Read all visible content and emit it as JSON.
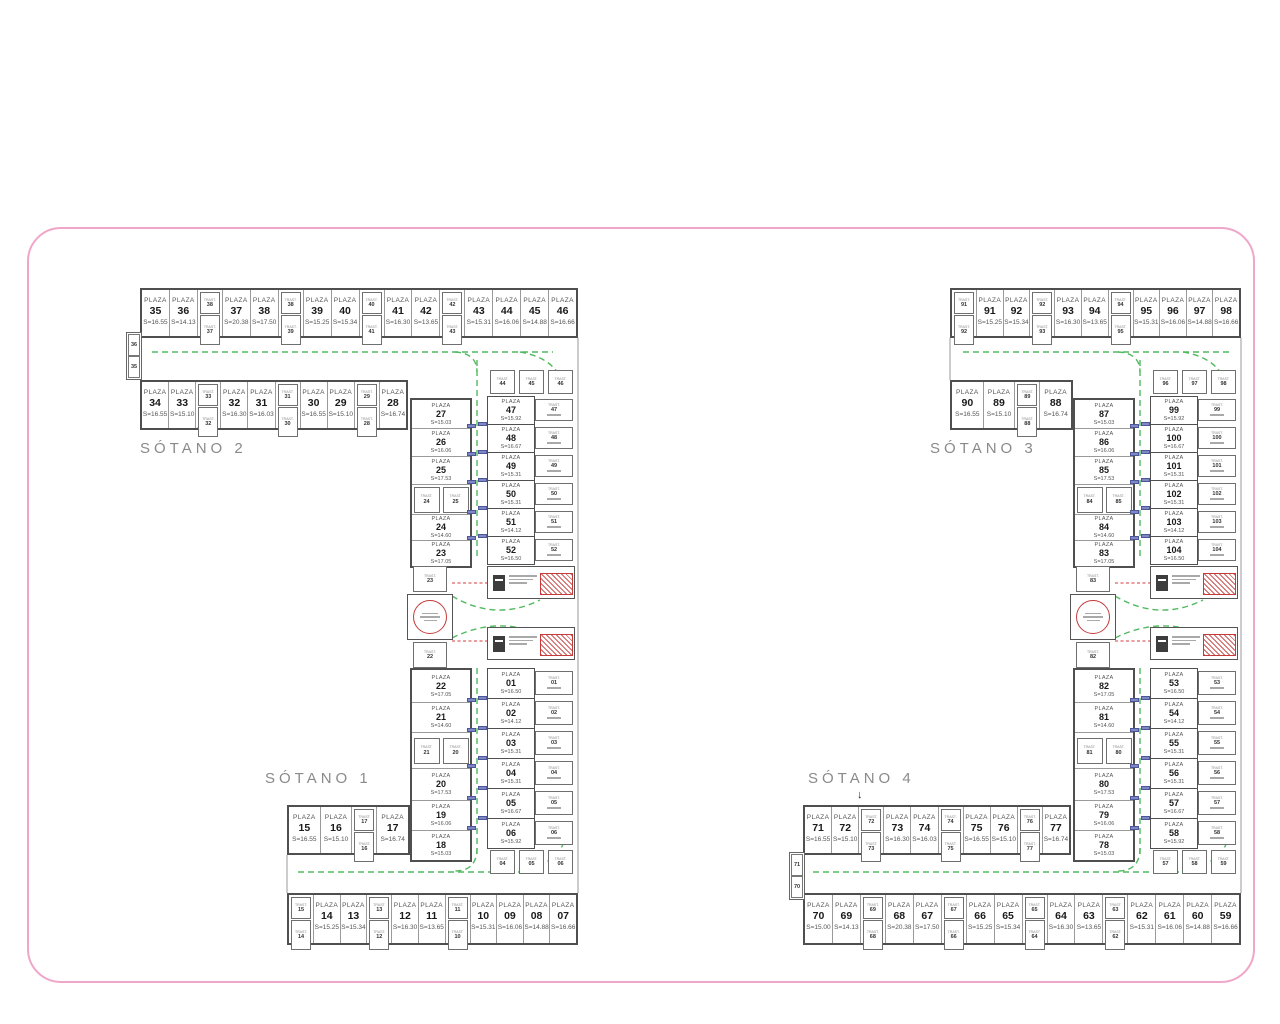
{
  "colors": {
    "boundary_pink": "#f0a6c8",
    "lane_green": "#3fb24e",
    "ramp_red": "#e06060",
    "stair_red": "#c43b3b",
    "door_blue": "#7f88c2",
    "wall_gray": "#4f4f4f"
  },
  "words": {
    "plaza": "PLAZA",
    "trast": "TRAST.",
    "area_prefix": "S=",
    "arrows": {
      "up": "↑",
      "down": "↓"
    }
  },
  "floors": {
    "sotano1": "SÓTANO 1",
    "sotano2": "SÓTANO 2",
    "sotano3": "SÓTANO 3",
    "sotano4": "SÓTANO 4"
  },
  "plans": [
    {
      "label_top": "SÓTANO 2",
      "label_bottom": "SÓTANO 1",
      "row_a": [
        {
          "n": "35",
          "s": "16.55"
        },
        {
          "n": "36",
          "s": "14.13"
        },
        {
          "t": [
            "38",
            "37"
          ]
        },
        {
          "n": "37",
          "s": "20.38"
        },
        {
          "n": "38",
          "s": "17.50"
        },
        {
          "t": [
            "38",
            "39"
          ]
        },
        {
          "n": "39",
          "s": "15.25"
        },
        {
          "n": "40",
          "s": "15.34"
        },
        {
          "t": [
            "40",
            "41"
          ]
        },
        {
          "n": "41",
          "s": "16.30"
        },
        {
          "n": "42",
          "s": "13.65"
        },
        {
          "t": [
            "42",
            "43"
          ]
        },
        {
          "n": "43",
          "s": "15.31"
        },
        {
          "n": "44",
          "s": "16.06"
        },
        {
          "n": "45",
          "s": "14.88"
        },
        {
          "n": "46",
          "s": "16.66"
        }
      ],
      "row_b": [
        {
          "n": "34",
          "s": "16.55"
        },
        {
          "n": "33",
          "s": "15.10"
        },
        {
          "t": [
            "33",
            "32"
          ]
        },
        {
          "n": "32",
          "s": "16.30"
        },
        {
          "n": "31",
          "s": "16.03"
        },
        {
          "t": [
            "31",
            "30"
          ]
        },
        {
          "n": "30",
          "s": "16.55"
        },
        {
          "n": "29",
          "s": "15.10"
        },
        {
          "t": [
            "29",
            "28"
          ]
        },
        {
          "n": "28",
          "s": "16.74"
        }
      ],
      "row_c": [
        {
          "n": "15",
          "s": "16.55"
        },
        {
          "n": "16",
          "s": "15.10"
        },
        {
          "t": [
            "17",
            "16"
          ]
        },
        {
          "n": "17",
          "s": "16.74"
        }
      ],
      "row_d": [
        {
          "t": [
            "15",
            "14"
          ]
        },
        {
          "n": "14",
          "s": "15.25"
        },
        {
          "n": "13",
          "s": "15.34"
        },
        {
          "t": [
            "13",
            "12"
          ]
        },
        {
          "n": "12",
          "s": "16.30"
        },
        {
          "n": "11",
          "s": "13.65"
        },
        {
          "t": [
            "11",
            "10"
          ]
        },
        {
          "n": "10",
          "s": "15.31"
        },
        {
          "n": "09",
          "s": "16.06"
        },
        {
          "n": "08",
          "s": "14.88"
        },
        {
          "n": "07",
          "s": "16.66"
        }
      ],
      "col_ul": [
        {
          "n": "27",
          "s": "15.03"
        },
        {
          "n": "26",
          "s": "16.06"
        },
        {
          "n": "25",
          "s": "17.53"
        },
        {
          "t": [
            "24",
            "25"
          ]
        },
        {
          "n": "24",
          "s": "14.60"
        },
        {
          "n": "23",
          "s": "17.05"
        }
      ],
      "col_ur": [
        {
          "n": "47",
          "s": "15.92"
        },
        {
          "n": "48",
          "s": "16.67"
        },
        {
          "n": "49",
          "s": "15.31"
        },
        {
          "n": "50",
          "s": "15.31"
        },
        {
          "n": "51",
          "s": "14.12"
        },
        {
          "n": "52",
          "s": "16.50"
        }
      ],
      "col_ll": [
        {
          "n": "22",
          "s": "17.05"
        },
        {
          "n": "21",
          "s": "14.60"
        },
        {
          "t": [
            "21",
            "20"
          ]
        },
        {
          "n": "20",
          "s": "17.53"
        },
        {
          "n": "19",
          "s": "16.06"
        },
        {
          "n": "18",
          "s": "15.03"
        }
      ],
      "col_lr": [
        {
          "n": "01",
          "s": "16.50"
        },
        {
          "n": "02",
          "s": "14.12"
        },
        {
          "n": "03",
          "s": "15.31"
        },
        {
          "n": "04",
          "s": "15.31"
        },
        {
          "n": "05",
          "s": "16.67"
        },
        {
          "n": "06",
          "s": "15.92"
        }
      ],
      "band_top": [
        "44",
        "45",
        "46"
      ],
      "band_bottom": [
        "04",
        "05",
        "06"
      ],
      "jt_top": "23",
      "jt_bottom": "22",
      "edge_labels": [
        "36",
        "35"
      ]
    },
    {
      "label_top": "SÓTANO 3",
      "label_bottom": "SÓTANO 4",
      "row_a": [
        {
          "t": [
            "91",
            "92"
          ]
        },
        {
          "n": "91",
          "s": "15.25"
        },
        {
          "n": "92",
          "s": "15.34"
        },
        {
          "t": [
            "92",
            "93"
          ]
        },
        {
          "n": "93",
          "s": "16.30"
        },
        {
          "n": "94",
          "s": "13.65"
        },
        {
          "t": [
            "94",
            "95"
          ]
        },
        {
          "n": "95",
          "s": "15.31"
        },
        {
          "n": "96",
          "s": "16.06"
        },
        {
          "n": "97",
          "s": "14.88"
        },
        {
          "n": "98",
          "s": "16.66"
        }
      ],
      "row_b": [
        {
          "n": "90",
          "s": "16.55"
        },
        {
          "n": "89",
          "s": "15.10"
        },
        {
          "t": [
            "89",
            "88"
          ]
        },
        {
          "n": "88",
          "s": "16.74"
        }
      ],
      "row_c": [
        {
          "n": "71",
          "s": "16.55"
        },
        {
          "n": "72",
          "s": "15.10"
        },
        {
          "t": [
            "72",
            "73"
          ]
        },
        {
          "n": "73",
          "s": "16.30"
        },
        {
          "n": "74",
          "s": "16.03"
        },
        {
          "t": [
            "74",
            "75"
          ]
        },
        {
          "n": "75",
          "s": "16.55"
        },
        {
          "n": "76",
          "s": "15.10"
        },
        {
          "t": [
            "76",
            "77"
          ]
        },
        {
          "n": "77",
          "s": "16.74"
        }
      ],
      "row_d": [
        {
          "n": "70",
          "s": "15.00"
        },
        {
          "n": "69",
          "s": "14.13"
        },
        {
          "t": [
            "69",
            "68"
          ]
        },
        {
          "n": "68",
          "s": "20.38"
        },
        {
          "n": "67",
          "s": "17.50"
        },
        {
          "t": [
            "67",
            "66"
          ]
        },
        {
          "n": "66",
          "s": "15.25"
        },
        {
          "n": "65",
          "s": "15.34"
        },
        {
          "t": [
            "65",
            "64"
          ]
        },
        {
          "n": "64",
          "s": "16.30"
        },
        {
          "n": "63",
          "s": "13.65"
        },
        {
          "t": [
            "63",
            "62"
          ]
        },
        {
          "n": "62",
          "s": "15.31"
        },
        {
          "n": "61",
          "s": "16.06"
        },
        {
          "n": "60",
          "s": "14.88"
        },
        {
          "n": "59",
          "s": "16.66"
        }
      ],
      "col_ul": [
        {
          "n": "87",
          "s": "15.03"
        },
        {
          "n": "86",
          "s": "16.06"
        },
        {
          "n": "85",
          "s": "17.53"
        },
        {
          "t": [
            "84",
            "85"
          ]
        },
        {
          "n": "84",
          "s": "14.60"
        },
        {
          "n": "83",
          "s": "17.05"
        }
      ],
      "col_ur": [
        {
          "n": "99",
          "s": "15.92"
        },
        {
          "n": "100",
          "s": "16.67"
        },
        {
          "n": "101",
          "s": "15.31"
        },
        {
          "n": "102",
          "s": "15.31"
        },
        {
          "n": "103",
          "s": "14.12"
        },
        {
          "n": "104",
          "s": "16.50"
        }
      ],
      "col_ll": [
        {
          "n": "82",
          "s": "17.05"
        },
        {
          "n": "81",
          "s": "14.60"
        },
        {
          "t": [
            "81",
            "80"
          ]
        },
        {
          "n": "80",
          "s": "17.53"
        },
        {
          "n": "79",
          "s": "16.06"
        },
        {
          "n": "78",
          "s": "15.03"
        }
      ],
      "col_lr": [
        {
          "n": "53",
          "s": "16.50"
        },
        {
          "n": "54",
          "s": "14.12"
        },
        {
          "n": "55",
          "s": "15.31"
        },
        {
          "n": "56",
          "s": "15.31"
        },
        {
          "n": "57",
          "s": "16.67"
        },
        {
          "n": "58",
          "s": "15.92"
        }
      ],
      "band_top": [
        "96",
        "97",
        "98"
      ],
      "band_bottom": [
        "57",
        "58",
        "59"
      ],
      "jt_top": "83",
      "jt_bottom": "82",
      "edge_labels": [
        "71",
        "70"
      ]
    }
  ]
}
